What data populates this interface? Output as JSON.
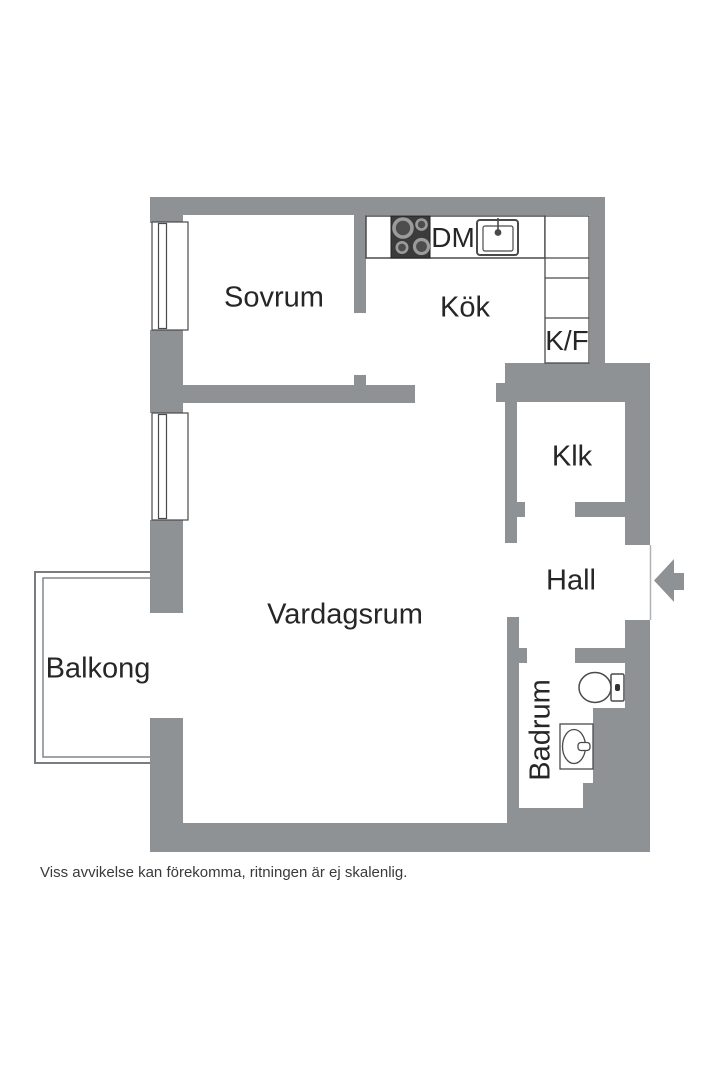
{
  "page": {
    "background": "#ffffff",
    "wall_color": "#8f9295",
    "outline_color": "#4a4a4a",
    "balcony_line_color": "#7a7d80",
    "text_color": "#262626",
    "stove_color": "#3b3b3b",
    "burner_ring_color": "#9b9b9b",
    "burner_fill_color": "#4d4d4d"
  },
  "rooms": {
    "sovrum": "Sovrum",
    "kok": "Kök",
    "vardagsrum": "Vardagsrum",
    "hall": "Hall",
    "klk": "Klk",
    "badrum": "Badrum",
    "balkong": "Balkong"
  },
  "appliances": {
    "dishwasher": "DM",
    "fridge_freezer": "K/F"
  },
  "icons": {
    "stove": "stove-burners-icon",
    "sink": "kitchen-sink-icon",
    "toilet": "toilet-icon",
    "washbasin": "washbasin-icon",
    "entrance": "entrance-arrow-icon",
    "window": "window-icon"
  },
  "footer": {
    "disclaimer": "Viss avvikelse kan förekomma, ritningen är ej skalenlig."
  }
}
